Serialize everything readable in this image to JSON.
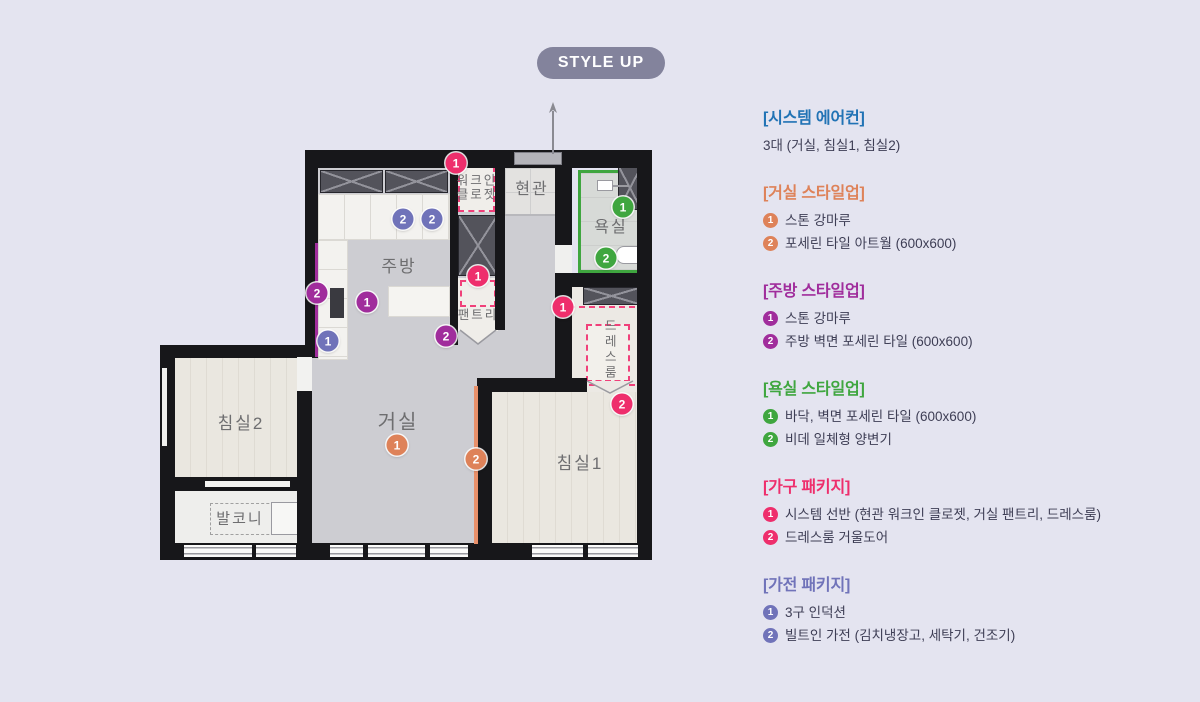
{
  "badge": {
    "label": "STYLE UP"
  },
  "colors": {
    "page_bg": "#e4e4f0",
    "badge_bg": "#83839c",
    "wall": "#17171a",
    "pink_dash": "#f0407a",
    "floor_grey": "#cdcdd2",
    "wood": "#eae7e0"
  },
  "legend": {
    "sections": [
      {
        "id": "aircon",
        "color": "#2173b5",
        "title": "[시스템 에어컨]",
        "note": "3대 (거실, 침실1, 침실2)",
        "items": []
      },
      {
        "id": "living",
        "color": "#de8259",
        "title": "[거실 스타일업]",
        "items": [
          "스톤 강마루",
          "포세린 타일 아트월 (600x600)"
        ]
      },
      {
        "id": "kitchen",
        "color": "#a02d9c",
        "title": "[주방 스타일업]",
        "items": [
          "스톤 강마루",
          "주방 벽면 포세린 타일 (600x600)"
        ]
      },
      {
        "id": "bath",
        "color": "#3fa63f",
        "title": "[욕실 스타일업]",
        "items": [
          "바닥, 벽면 포세린 타일 (600x600)",
          "비데 일체형 양변기"
        ]
      },
      {
        "id": "furniture",
        "color": "#ee2e6c",
        "title": "[가구 패키지]",
        "items": [
          "시스템 선반 (현관 워크인 클로젯, 거실 팬트리, 드레스룸)",
          "드레스룸 거울도어"
        ]
      },
      {
        "id": "appliance",
        "color": "#7073b9",
        "title": "[가전 패키지]",
        "items": [
          "3구 인덕션",
          "빌트인 가전 (김치냉장고, 세탁기, 건조기)"
        ]
      }
    ]
  },
  "floorplan": {
    "rooms": [
      {
        "id": "walk-in-closet",
        "label": "워크인\n클로젯",
        "x": 477,
        "y": 188,
        "size": 12.5
      },
      {
        "id": "entrance",
        "label": "현관",
        "x": 532,
        "y": 190,
        "size": 16
      },
      {
        "id": "bathroom",
        "label": "욕실",
        "x": 611,
        "y": 228,
        "size": 16
      },
      {
        "id": "kitchen",
        "label": "주방",
        "x": 399,
        "y": 267,
        "size": 17
      },
      {
        "id": "pantry",
        "label": "팬트리",
        "x": 478,
        "y": 315,
        "size": 12.5
      },
      {
        "id": "dress-room",
        "label": "드레스룸",
        "x": 609,
        "y": 350,
        "size": 12.5,
        "vertical": true
      },
      {
        "id": "bedroom2",
        "label": "침실2",
        "x": 241,
        "y": 424,
        "size": 17
      },
      {
        "id": "living-room",
        "label": "거실",
        "x": 398,
        "y": 423,
        "size": 20
      },
      {
        "id": "bedroom1",
        "label": "침실1",
        "x": 580,
        "y": 464,
        "size": 17
      },
      {
        "id": "balcony",
        "label": "발코니",
        "x": 240,
        "y": 519,
        "size": 15
      }
    ],
    "markers": [
      {
        "section": "furniture",
        "n": "1",
        "x": 456,
        "y": 163
      },
      {
        "section": "appliance",
        "n": "2",
        "x": 403,
        "y": 219
      },
      {
        "section": "appliance",
        "n": "2",
        "x": 432,
        "y": 219
      },
      {
        "section": "bath",
        "n": "1",
        "x": 623,
        "y": 207
      },
      {
        "section": "bath",
        "n": "2",
        "x": 606,
        "y": 258
      },
      {
        "section": "kitchen",
        "n": "2",
        "x": 317,
        "y": 293
      },
      {
        "section": "kitchen",
        "n": "1",
        "x": 367,
        "y": 302
      },
      {
        "section": "appliance",
        "n": "1",
        "x": 328,
        "y": 341
      },
      {
        "section": "furniture",
        "n": "1",
        "x": 478,
        "y": 276
      },
      {
        "section": "kitchen",
        "n": "2",
        "x": 446,
        "y": 336
      },
      {
        "section": "furniture",
        "n": "1",
        "x": 563,
        "y": 307
      },
      {
        "section": "furniture",
        "n": "2",
        "x": 622,
        "y": 404
      },
      {
        "section": "living",
        "n": "1",
        "x": 397,
        "y": 445
      },
      {
        "section": "living",
        "n": "2",
        "x": 476,
        "y": 459
      }
    ]
  }
}
